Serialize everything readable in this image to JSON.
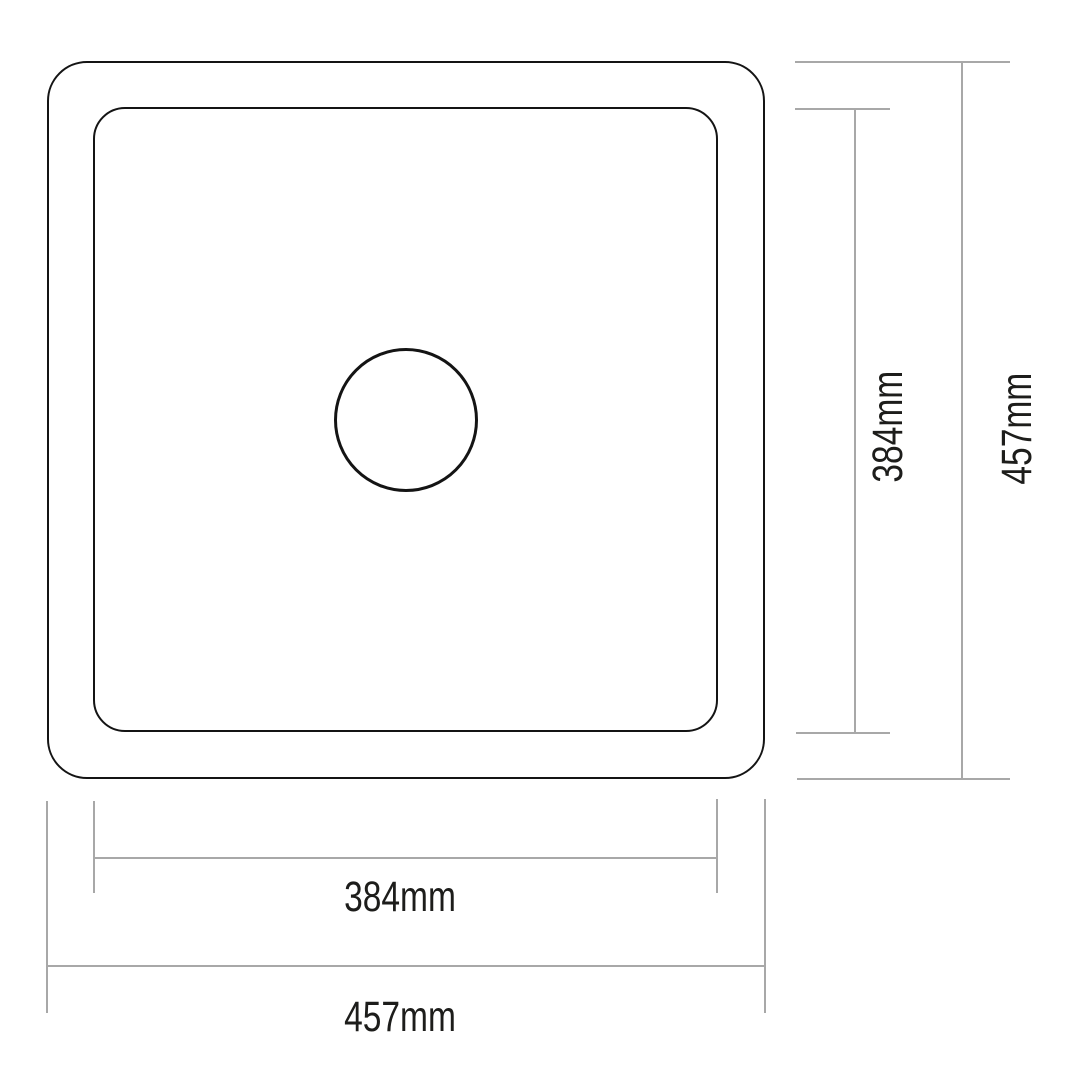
{
  "diagram": {
    "type": "technical-drawing",
    "subject": "square-sink-top-view",
    "colors": {
      "background": "#ffffff",
      "outline": "#141414",
      "dimension_line": "#a8a8a8",
      "label_text": "#1d1d1b"
    },
    "dimensions": {
      "outer_width": {
        "label": "457mm"
      },
      "outer_height": {
        "label": "457mm"
      },
      "inner_width": {
        "label": "384mm"
      },
      "inner_height": {
        "label": "384mm"
      }
    }
  }
}
